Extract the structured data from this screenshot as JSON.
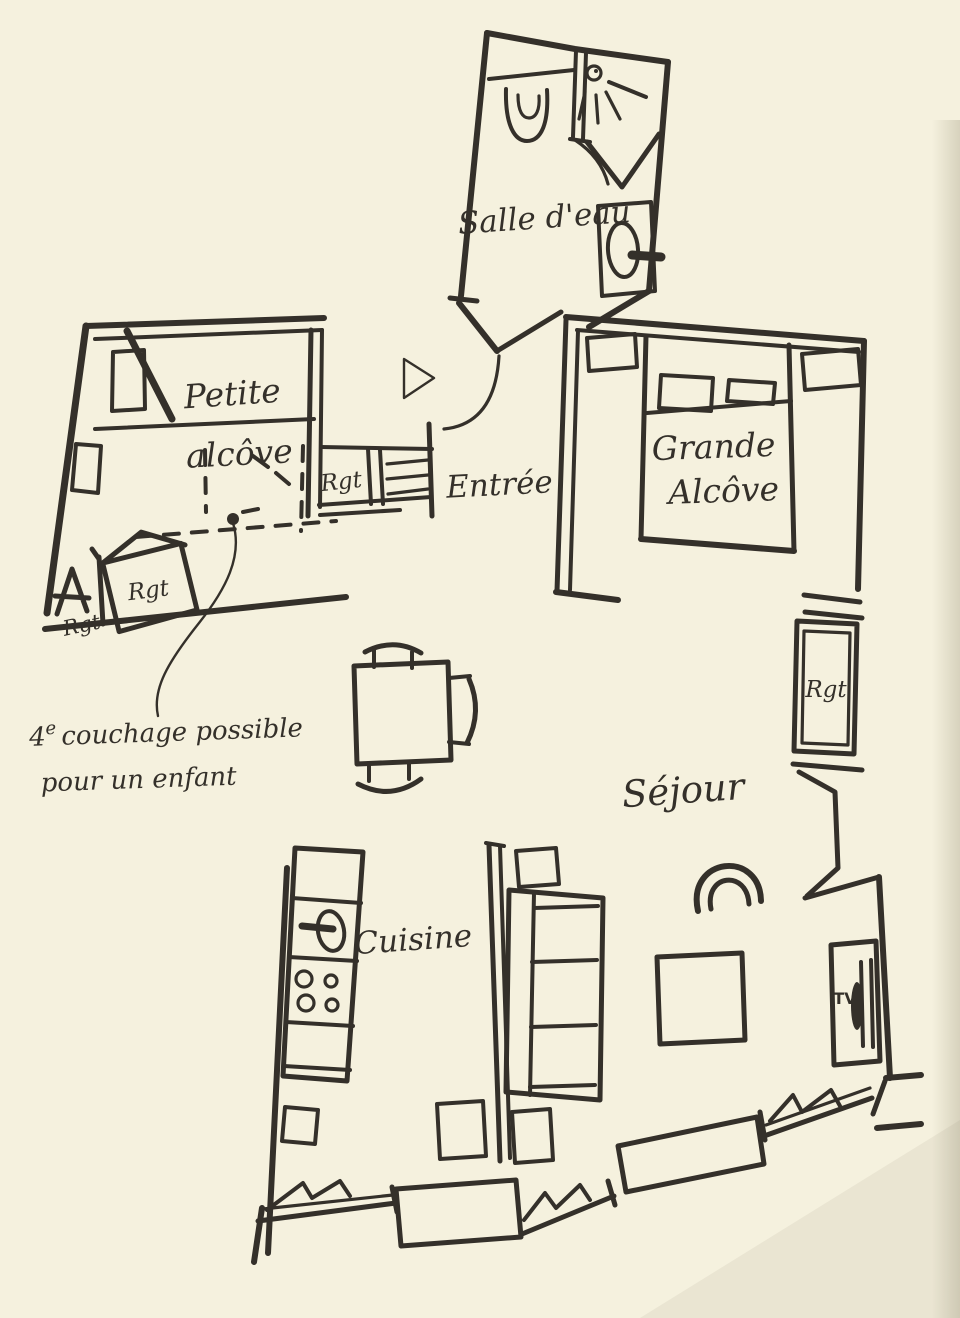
{
  "colors": {
    "paper": "#f5f1de",
    "ink": "#34302a",
    "shadow": "#8a8268"
  },
  "rooms": {
    "salle_deau": {
      "label": "Salle d'eau"
    },
    "petite_alcove": {
      "line1": "Petite",
      "line2": "alcôve"
    },
    "entree": {
      "label": "Entrée"
    },
    "grande_alcove": {
      "line1": "Grande",
      "line2": "Alcôve"
    },
    "sejour": {
      "label": "Séjour"
    },
    "cuisine": {
      "label": "Cuisine"
    }
  },
  "storage": {
    "petite_alcove_box": "Rgt",
    "petite_alcove_corner": "Rgt",
    "entree_closet": "Rgt",
    "sejour_closet": "Rgt"
  },
  "media": {
    "tv": "TV"
  },
  "annotation": {
    "number": "4",
    "superscript": "e",
    "line1_rest": "couchage possible",
    "line2": "pour un enfant"
  }
}
